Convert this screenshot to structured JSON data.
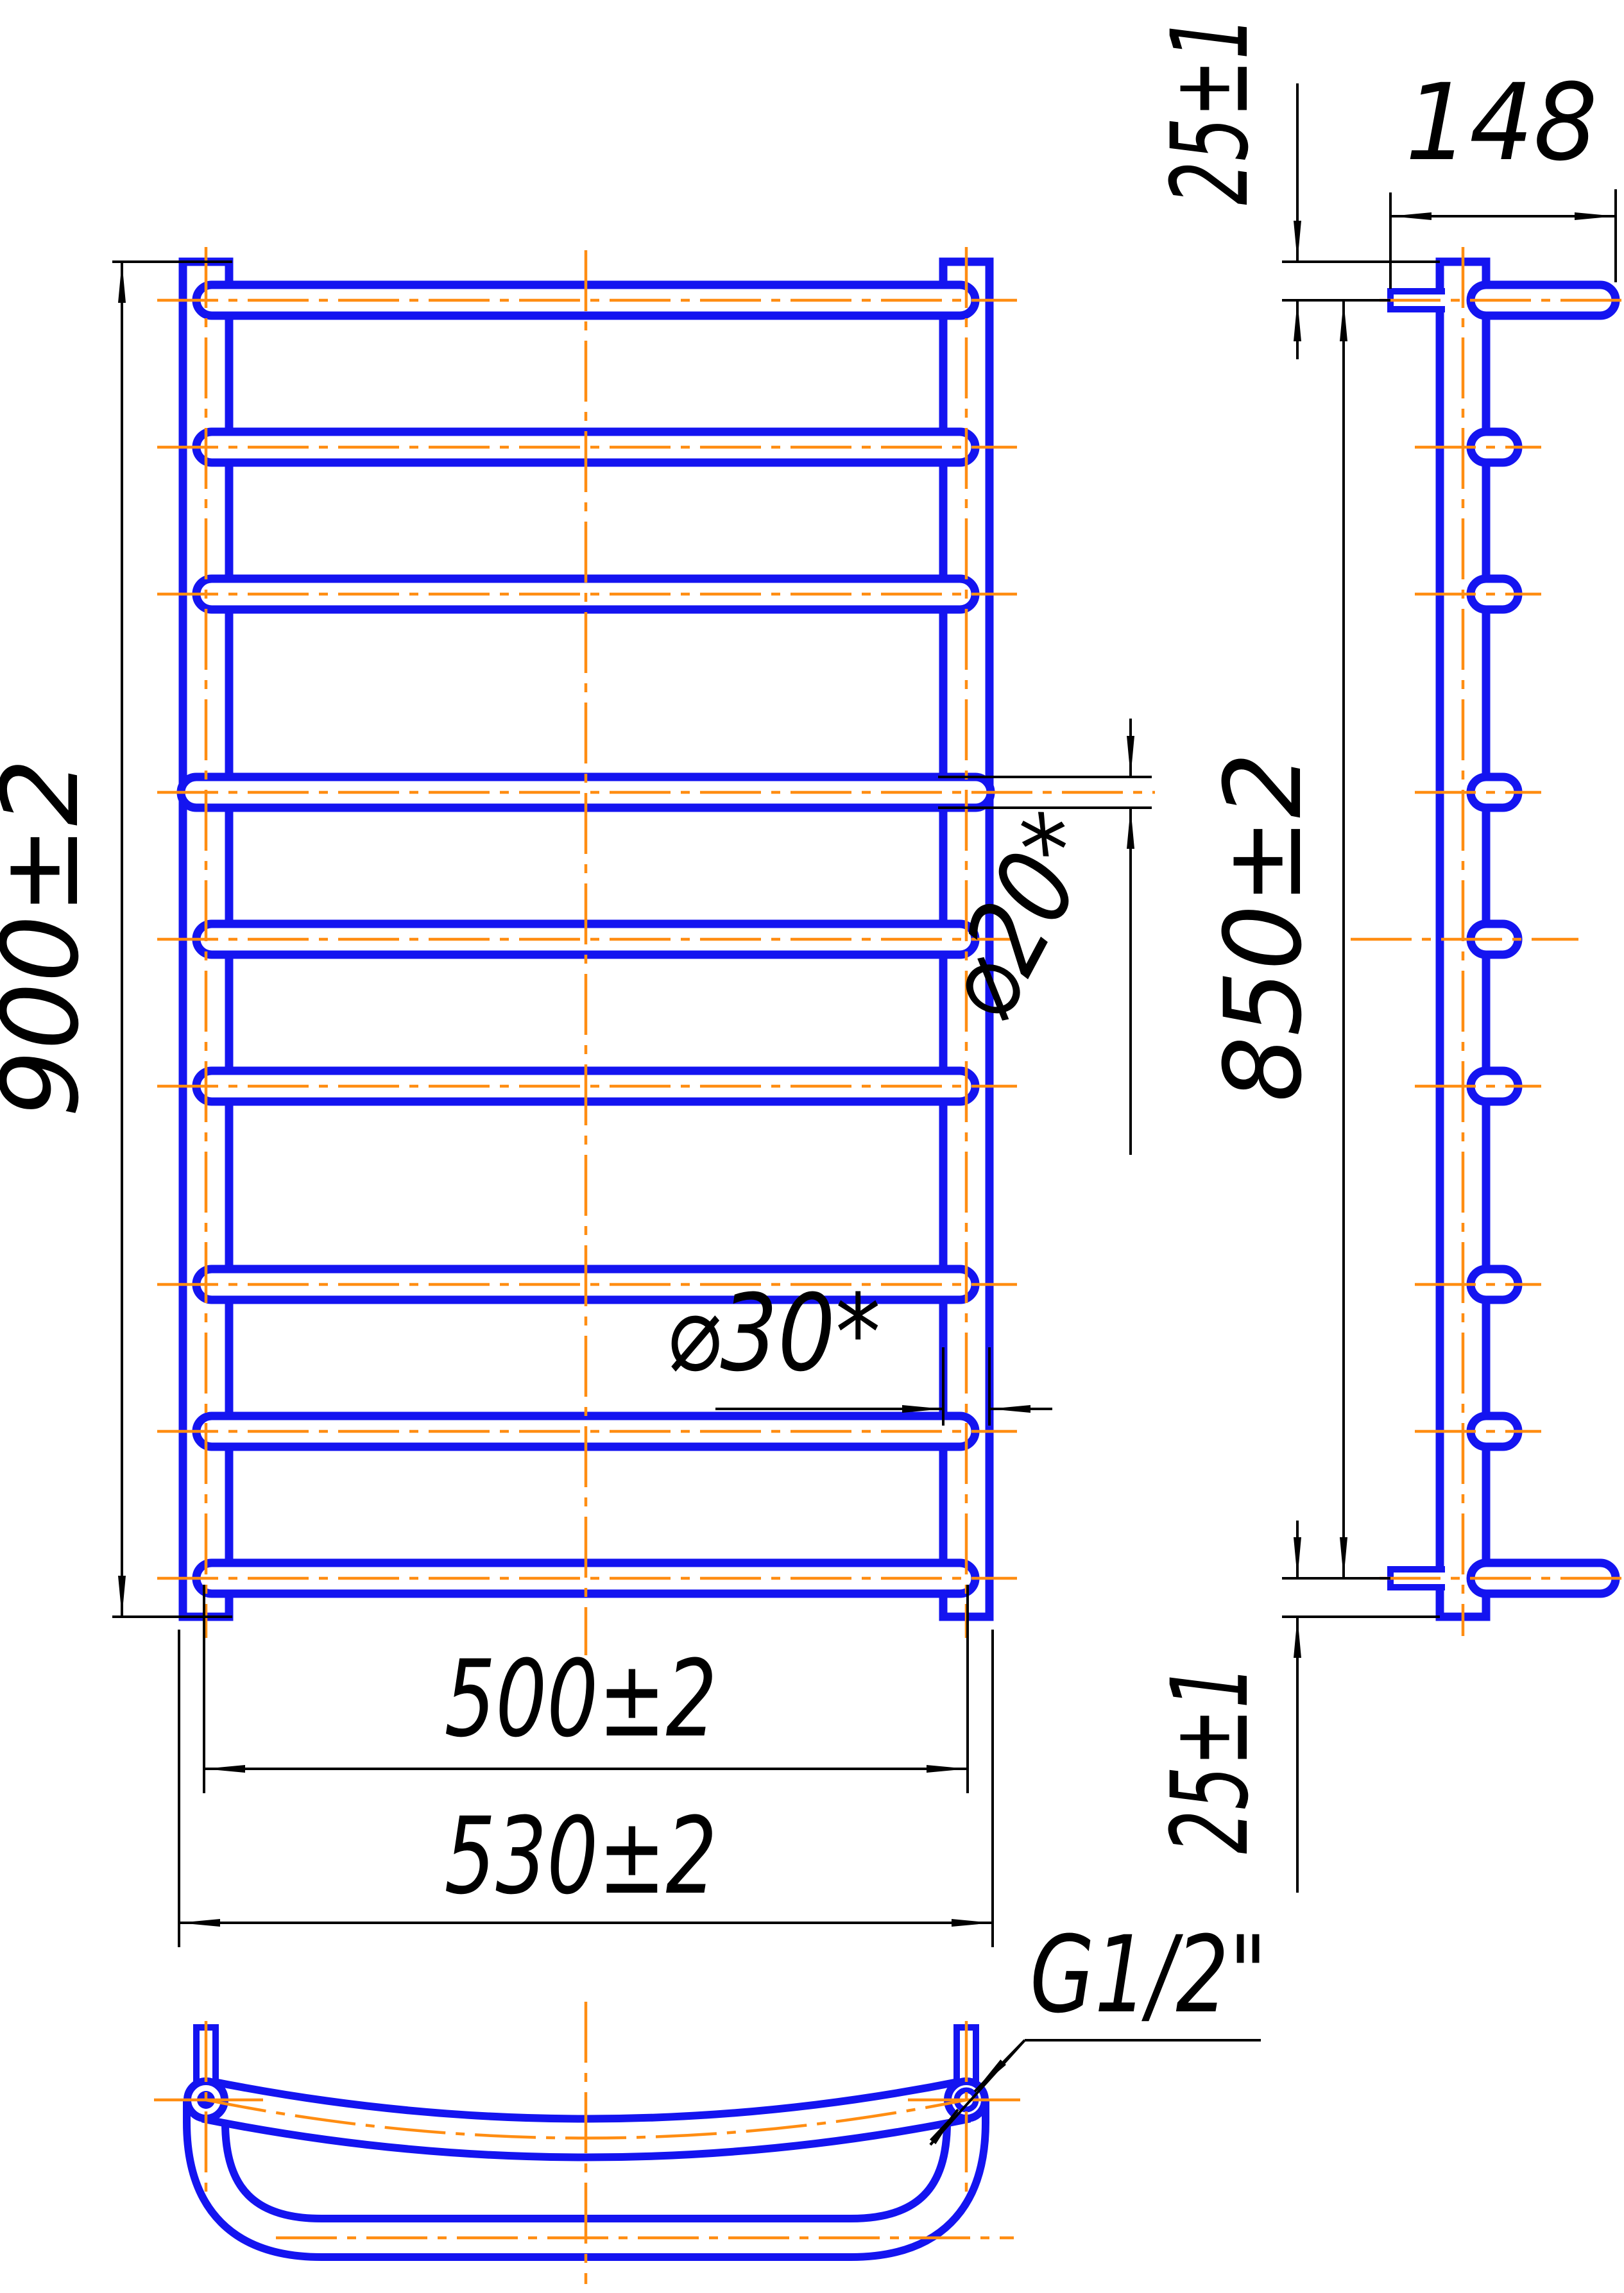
{
  "title": "Ladder towel rail — technical drawing, three views",
  "views": {
    "front": {
      "height_dim": "900±2",
      "rung_span_dim": "500±2",
      "overall_width_dim": "530±2",
      "rung_diameter_dim": "⌀20*",
      "collector_diameter_dim": "⌀30*",
      "rungs_count": 9
    },
    "side": {
      "top_offset_dim": "25±1",
      "depth_dim": "148",
      "axes_span_dim": "850±2",
      "bottom_offset_dim": "25±1"
    },
    "bottom": {
      "thread_label": "G1/2\""
    }
  },
  "colors": {
    "tube_outline": "#1414f0",
    "centerline": "#ff8d12",
    "dimension": "#000000",
    "background": "#ffffff"
  }
}
